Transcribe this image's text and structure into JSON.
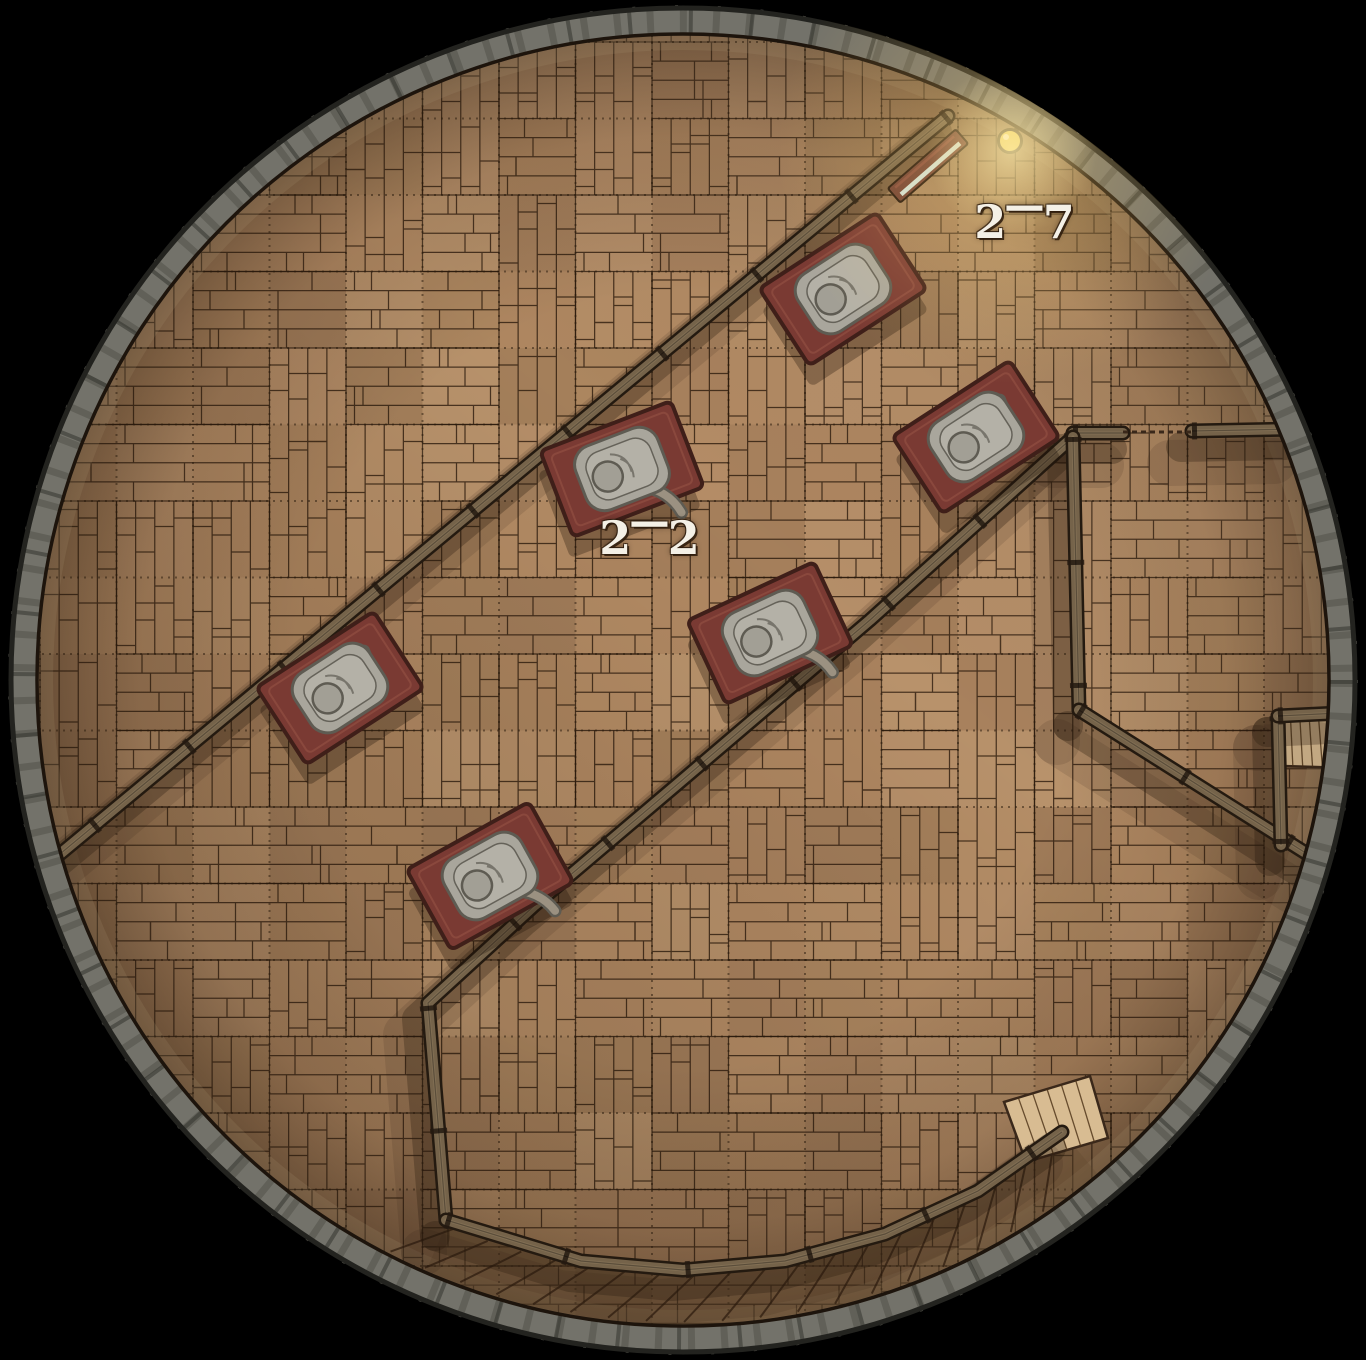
{
  "map": {
    "type": "top-down battle map, circular tower interior with wooden plank floor",
    "background_color": "#000000",
    "tower": {
      "cx": 683,
      "cy": 680,
      "outer_radius": 673,
      "ring_outer": 672,
      "ring_inner": 646,
      "floor_radius": 646
    },
    "grid": {
      "size": 76.5,
      "offset_x": 40,
      "offset_y": 42
    },
    "labels": [
      {
        "id": "room-2-7",
        "text": "2-7",
        "x": 1025,
        "y": 222
      },
      {
        "id": "room-2-2",
        "text": "2-2",
        "x": 650,
        "y": 538
      }
    ],
    "walls": [
      {
        "name": "corridor-wall-upper",
        "points": [
          [
            948,
            116
          ],
          [
            60,
            854
          ]
        ]
      },
      {
        "name": "corridor-wall-lower",
        "points": [
          [
            1073,
            437
          ],
          [
            870,
            620
          ],
          [
            680,
            782
          ],
          [
            535,
            905
          ],
          [
            428,
            1003
          ],
          [
            437,
            1110
          ],
          [
            446,
            1220
          ]
        ]
      },
      {
        "name": "east-wall-top-west",
        "points": [
          [
            1073,
            433
          ],
          [
            1123,
            433
          ]
        ]
      },
      {
        "name": "east-wall-top-east",
        "points": [
          [
            1192,
            431
          ],
          [
            1296,
            429
          ]
        ]
      },
      {
        "name": "east-wall-vertical",
        "points": [
          [
            1073,
            437
          ],
          [
            1079,
            710
          ]
        ]
      },
      {
        "name": "southeast-diagonal",
        "points": [
          [
            1079,
            710
          ],
          [
            1320,
            862
          ]
        ]
      },
      {
        "name": "alcove-wall-vertical",
        "points": [
          [
            1278,
            716
          ],
          [
            1281,
            845
          ]
        ]
      },
      {
        "name": "alcove-wall-top",
        "points": [
          [
            1278,
            716
          ],
          [
            1340,
            713
          ]
        ]
      },
      {
        "name": "stair-wall-arc",
        "points": [
          [
            446,
            1220
          ],
          [
            581,
            1261
          ],
          [
            683,
            1270
          ],
          [
            785,
            1261
          ],
          [
            885,
            1234
          ],
          [
            978,
            1191
          ],
          [
            1062,
            1132
          ]
        ]
      }
    ],
    "doorway_threshold": {
      "points": [
        [
          1123,
          432
        ],
        [
          1192,
          432
        ]
      ]
    },
    "stairs": {
      "inner_radius": 592,
      "outer_radius": 644,
      "start_angle": 50,
      "end_angle": 113.5,
      "step_deg": 3.4,
      "slant_deg": 4.5
    },
    "stair_landing": {
      "polygon": [
        [
          1004,
          1102
        ],
        [
          1090,
          1076
        ],
        [
          1108,
          1138
        ],
        [
          1026,
          1162
        ]
      ]
    },
    "alcove_floor": {
      "polygon": [
        [
          1281,
          714
        ],
        [
          1346,
          711
        ],
        [
          1352,
          768
        ],
        [
          1283,
          766
        ]
      ]
    },
    "bedrolls": [
      {
        "x": 843,
        "y": 289,
        "rotation": -33
      },
      {
        "x": 622,
        "y": 469,
        "rotation": -21
      },
      {
        "x": 976,
        "y": 437,
        "rotation": -33
      },
      {
        "x": 770,
        "y": 633,
        "rotation": -25
      },
      {
        "x": 340,
        "y": 688,
        "rotation": -33
      },
      {
        "x": 490,
        "y": 876,
        "rotation": -29
      }
    ],
    "door": {
      "x": 928,
      "y": 166,
      "rotation": -41,
      "width": 88,
      "height": 17
    },
    "lantern": {
      "x": 1010,
      "y": 141,
      "glow_x": 1012,
      "glow_y": 150
    },
    "colors": {
      "floor": "#b28a63",
      "floor_light": "#c9a77c",
      "plank_line": "#2a190b",
      "grid_line": "rgba(40,25,11,0.5)",
      "wall": "#75634a",
      "wall_dark": "#241a10",
      "wall_highlight": "#8d7a5c",
      "rim": "#73726a",
      "rim_dark": "#4c4b43",
      "rim_edge": "#23231f",
      "bedroll": "#7a3a33",
      "bedroll_dark": "#3f1f19",
      "bedroll_inner": "#8d4b40",
      "blanket": "#a9a69c",
      "blanket_dark": "#5e5b52",
      "blanket_inner": "#b6b3a9",
      "door": "#6b3a31",
      "door_stripe": "#d5ebe8",
      "lantern": "#e8cf52",
      "glow": "#ffd878",
      "light_planks": "#d8bc92",
      "shadow": "rgba(40,26,13,0.30)",
      "label_text": "#f4f0e6"
    }
  }
}
